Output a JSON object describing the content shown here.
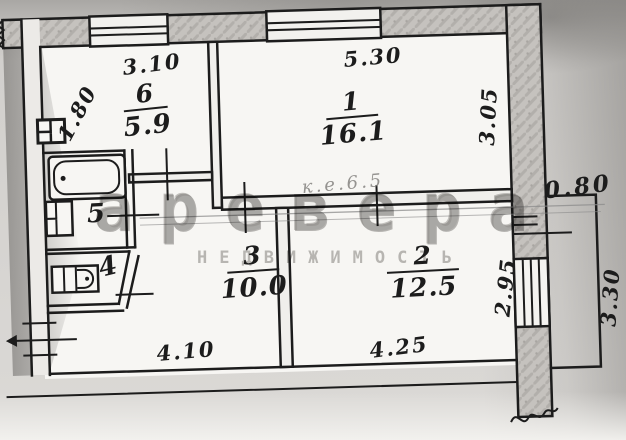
{
  "plan": {
    "rooms": [
      {
        "number": "6",
        "area": "5.9"
      },
      {
        "number": "1",
        "area": "16.1"
      },
      {
        "number": "3",
        "area": "10.0"
      },
      {
        "number": "2",
        "area": "12.5"
      },
      {
        "number": "5",
        "area": ""
      },
      {
        "number": "4",
        "area": ""
      }
    ],
    "dims": {
      "top_kitchen": "3.10",
      "left_kitchen": "1.80",
      "top_living": "5.30",
      "right_living": "3.05",
      "pencil_note": "к.е.6.5",
      "balcony_depth": "0.80",
      "right_room2": "2.95",
      "balcony_length": "3.30",
      "bottom_left": "4.10",
      "bottom_right": "4.25"
    }
  },
  "watermark": {
    "brand": "аревера",
    "tagline": "недвижимость"
  },
  "colors": {
    "ink": "#1c1c1c",
    "paper": "#f6f5f2",
    "wall": "#c5c2be",
    "watermark_gray": "#8d8b88"
  }
}
